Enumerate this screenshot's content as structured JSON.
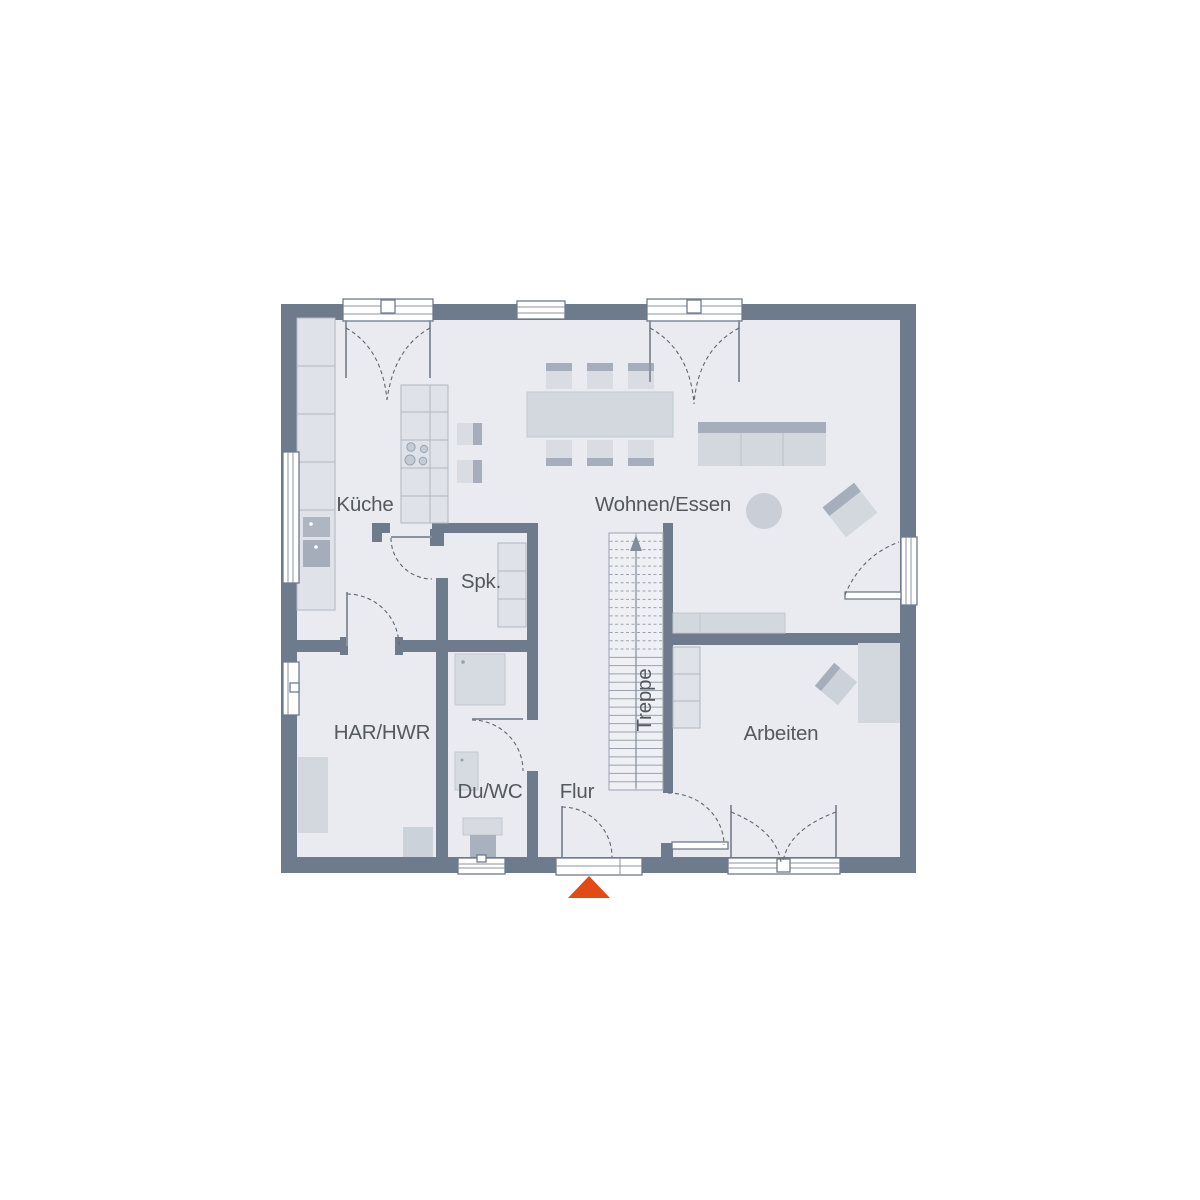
{
  "plan": {
    "rooms": [
      {
        "id": "kueche",
        "label": "Küche"
      },
      {
        "id": "wohnen_essen",
        "label": "Wohnen/Essen"
      },
      {
        "id": "spk",
        "label": "Spk."
      },
      {
        "id": "har_hwr",
        "label": "HAR/HWR"
      },
      {
        "id": "du_wc",
        "label": "Du/WC"
      },
      {
        "id": "flur",
        "label": "Flur"
      },
      {
        "id": "treppe",
        "label": "Treppe"
      },
      {
        "id": "arbeiten",
        "label": "Arbeiten"
      }
    ],
    "stairs": {
      "direction": "up"
    },
    "colors": {
      "wall": "#6e7b8c",
      "floor": "#e9ebf0",
      "furniture": "#d3d8df",
      "accent": "#a6aebb",
      "marker": "#e24a16",
      "label": "#54585f"
    }
  }
}
